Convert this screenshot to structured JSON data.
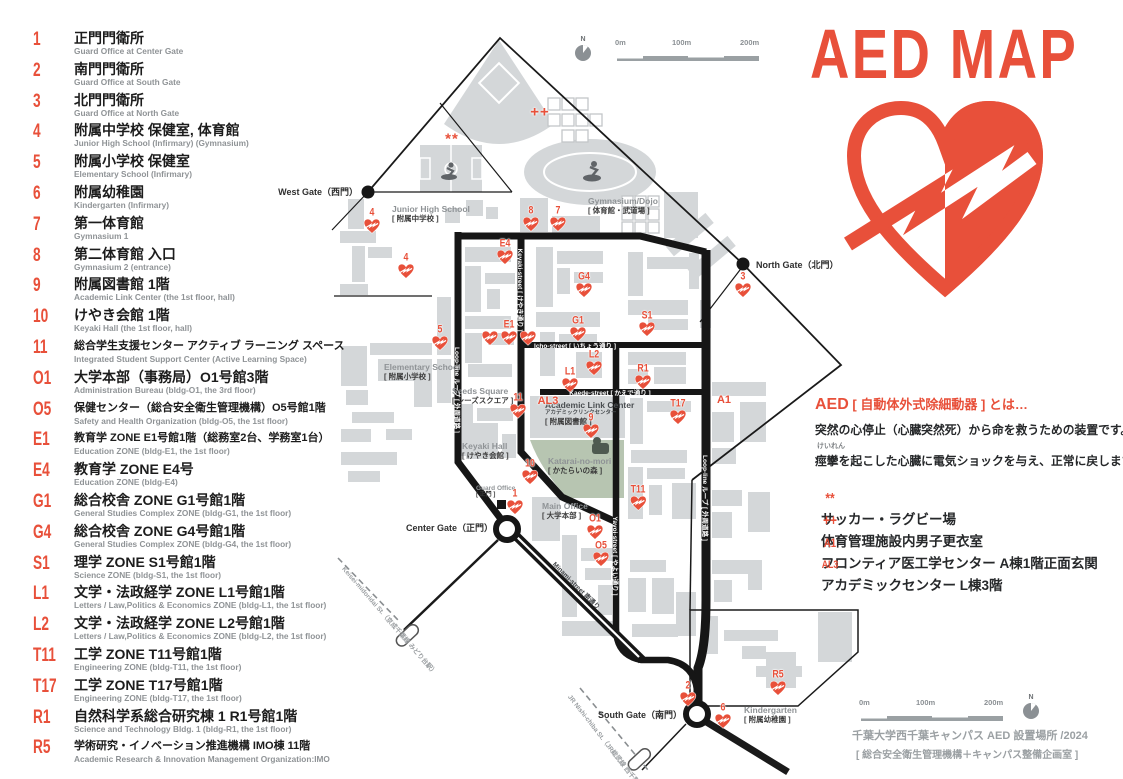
{
  "title": "AED MAP",
  "colors": {
    "red": "#e8503a",
    "building": "#d4d7d9",
    "road": "#161616",
    "green": "#b7c5b1"
  },
  "legend": {
    "items": [
      {
        "code": "1",
        "ja": "正門門衛所",
        "en": "Guard Office at Center Gate"
      },
      {
        "code": "2",
        "ja": "南門門衛所",
        "en": "Guard Office at South Gate"
      },
      {
        "code": "3",
        "ja": "北門門衛所",
        "en": "Guard Office at North Gate"
      },
      {
        "code": "4",
        "ja": "附属中学校 保健室, 体育館",
        "en": "Junior High School (Infirmary) (Gymnasium)"
      },
      {
        "code": "5",
        "ja": "附属小学校 保健室",
        "en": "Elementary School (Infirmary)"
      },
      {
        "code": "6",
        "ja": "附属幼稚園",
        "en": "Kindergarten (Infirmary)"
      },
      {
        "code": "7",
        "ja": "第一体育館",
        "en": "Gymnasium 1"
      },
      {
        "code": "8",
        "ja": "第二体育館 入口",
        "en": "Gymnasium 2 (entrance)"
      },
      {
        "code": "9",
        "ja": "附属図書館 1階",
        "en": "Academic Link Center (the 1st floor, hall)"
      },
      {
        "code": "10",
        "ja": "けやき会館 1階",
        "en": "Keyaki Hall (the 1st floor, hall)"
      },
      {
        "code": "11",
        "ja": "総合学生支援センター アクティブ ラーニング スペース",
        "en": "Integrated Student Support Center (Active Learning Space)"
      },
      {
        "code": "O1",
        "ja": "大学本部（事務局）O1号館3階",
        "en": "Administration Bureau (bldg-O1, the 3rd floor)"
      },
      {
        "code": "O5",
        "ja": "保健センター（総合安全衛生管理機構）O5号館1階",
        "en": "Safety and Health Organization (bldg-O5, the 1st floor)"
      },
      {
        "code": "E1",
        "ja": "教育学 ZONE E1号館1階（総務室2台、学務室1台）",
        "en": "Education ZONE (bldg-E1, the 1st floor)"
      },
      {
        "code": "E4",
        "ja": "教育学 ZONE E4号",
        "en": "Education ZONE (bldg-E4)"
      },
      {
        "code": "G1",
        "ja": "総合校舎 ZONE G1号館1階",
        "en": "General Studies Complex ZONE (bldg-G1, the 1st floor)"
      },
      {
        "code": "G4",
        "ja": "総合校舎 ZONE G4号館1階",
        "en": "General Studies Complex ZONE (bldg-G4, the 1st floor)"
      },
      {
        "code": "S1",
        "ja": "理学 ZONE S1号館1階",
        "en": "Science ZONE (bldg-S1, the 1st floor)"
      },
      {
        "code": "L1",
        "ja": "文学・法政経学 ZONE L1号館1階",
        "en": "Letters / Law,Politics & Economics ZONE (bldg-L1, the 1st floor)"
      },
      {
        "code": "L2",
        "ja": "文学・法政経学 ZONE L2号館1階",
        "en": "Letters / Law,Politics & Economics ZONE (bldg-L2, the 1st floor)"
      },
      {
        "code": "T11",
        "ja": "工学 ZONE T11号館1階",
        "en": "Engineering ZONE (bldg-T11, the 1st floor)"
      },
      {
        "code": "T17",
        "ja": "工学 ZONE T17号館1階",
        "en": "Engineering ZONE (bldg-T17, the 1st floor)"
      },
      {
        "code": "R1",
        "ja": "自然科学系総合研究棟 1  R1号館1階",
        "en": "Science and Technology Bldg. 1 (bldg-R1, the 1st floor)"
      },
      {
        "code": "R5",
        "ja": "学術研究・イノベーション推進機構 IMO棟 11階",
        "en": "Academic Research & Innovation Management Organization:IMO"
      }
    ]
  },
  "info": {
    "heading_code": "AED",
    "heading_rest": " [ 自動体外式除細動器 ] とは…",
    "body1": "突然の心停止（心臓突然死）から命を救うための装置です。",
    "furigana": "けいれん",
    "body2": "痙攣を起こした心臓に電気ショックを与え、正常に戻します。",
    "notes": [
      {
        "code": "**",
        "label": "サッカー・ラグビー場"
      },
      {
        "code": "++",
        "label": "体育管理施設内男子更衣室"
      },
      {
        "code": "A1",
        "label": "フロンティア医工学センター A棟1階正面玄関"
      },
      {
        "code": "AL3",
        "label": "アカデミックセンター L棟3階"
      }
    ]
  },
  "credit": {
    "line1": "千葉大学西千葉キャンパス AED 設置場所 /2024",
    "line2": "[ 総合安全衛生管理機構＋キャンパス整備企画室 ]"
  },
  "scalebar": {
    "labels": [
      "0m",
      "100m",
      "200m"
    ],
    "north": "N"
  },
  "map": {
    "gates": [
      {
        "name": "West Gate（西門）",
        "x": 358,
        "y": 185,
        "align": "right"
      },
      {
        "name": "North Gate（北門）",
        "x": 756,
        "y": 258,
        "align": "left"
      },
      {
        "name": "Center Gate（正門）",
        "x": 493,
        "y": 521,
        "align": "right"
      },
      {
        "name": "South Gate（南門）",
        "x": 682,
        "y": 708,
        "align": "right"
      }
    ],
    "places": [
      {
        "en": "Junior High School",
        "ja": "[ 附属中学校 ]",
        "x": 392,
        "y": 204
      },
      {
        "en": "Elementary School",
        "ja": "[ 附属小学校 ]",
        "x": 384,
        "y": 362
      },
      {
        "en": "Gymnasium/Dojo",
        "ja": "[ 体育館・武道場 ]",
        "x": 588,
        "y": 196
      },
      {
        "en": "Seeds Square",
        "ja": "[ シーズスクエア ]",
        "x": 452,
        "y": 386
      },
      {
        "en": "Academic Link Center",
        "sub": "アカデミックリンクセンター",
        "ja": "[ 附属図書館 ]",
        "x": 545,
        "y": 400,
        "dark": true
      },
      {
        "en": "Katarai-no-mori",
        "ja": "[ かたらいの森 ]",
        "x": 548,
        "y": 456
      },
      {
        "en": "Keyaki Hall",
        "ja": "[ けやき会館 ]",
        "x": 462,
        "y": 441
      },
      {
        "en": "Guard Office",
        "ja": "[ 正門 ]",
        "x": 476,
        "y": 485,
        "small": true
      },
      {
        "en": "Main Office",
        "ja": "[ 大学本部 ]",
        "x": 542,
        "y": 501
      },
      {
        "en": "Kindergarten",
        "ja": "[ 附属幼稚園 ]",
        "x": 744,
        "y": 705
      }
    ],
    "streets": [
      {
        "label": "Keyaki-street [ けやき通り ]",
        "x": 521,
        "y": 290,
        "rot": 90
      },
      {
        "label": "Icho-street [ いちょう通り ]",
        "x": 575,
        "y": 345,
        "rot": 0
      },
      {
        "label": "Kaede-street [ かえで通り ]",
        "x": 610,
        "y": 392,
        "rot": 0
      },
      {
        "label": "Yayoi-street [ やよい通り ]",
        "x": 616,
        "y": 556,
        "rot": 90
      },
      {
        "label": "Loop-line ループ [ 外周道路 ]",
        "x": 458,
        "y": 390,
        "rot": 90
      },
      {
        "label": "Loop-line ループ [ 外周道路 ]",
        "x": 706,
        "y": 498,
        "rot": 90
      },
      {
        "label": "Minami-street 南通り",
        "x": 577,
        "y": 585,
        "rot": 45,
        "dark": true
      }
    ],
    "rails": [
      {
        "label": "Keisei-midoridai St.（京成千葉線 みどり台駅）",
        "x": 344,
        "y": 562,
        "rot": 49
      },
      {
        "label": "JR Nishi-chiba St.（JR総武線 西千葉駅）",
        "x": 570,
        "y": 690,
        "rot": 52
      }
    ],
    "markers": [
      {
        "code": "4",
        "x": 372,
        "y": 226
      },
      {
        "code": "4",
        "x": 406,
        "y": 271
      },
      {
        "code": "5",
        "x": 440,
        "y": 343
      },
      {
        "code": "8",
        "x": 531,
        "y": 224
      },
      {
        "code": "7",
        "x": 558,
        "y": 224
      },
      {
        "code": "E4",
        "x": 505,
        "y": 257
      },
      {
        "code": "E1",
        "x": 509,
        "y": 338,
        "hearts": 3
      },
      {
        "code": "G4",
        "x": 584,
        "y": 290
      },
      {
        "code": "G1",
        "x": 578,
        "y": 334
      },
      {
        "code": "S1",
        "x": 647,
        "y": 329
      },
      {
        "code": "3",
        "x": 743,
        "y": 290
      },
      {
        "code": "L2",
        "x": 594,
        "y": 368
      },
      {
        "code": "L1",
        "x": 570,
        "y": 385
      },
      {
        "code": "R1",
        "x": 643,
        "y": 382
      },
      {
        "code": "11",
        "x": 518,
        "y": 411
      },
      {
        "code": "9",
        "x": 591,
        "y": 431
      },
      {
        "code": "T17",
        "x": 678,
        "y": 417
      },
      {
        "code": "10",
        "x": 530,
        "y": 477
      },
      {
        "code": "1",
        "x": 515,
        "y": 507
      },
      {
        "code": "T11",
        "x": 638,
        "y": 503
      },
      {
        "code": "O1",
        "x": 595,
        "y": 532
      },
      {
        "code": "O5",
        "x": 601,
        "y": 559
      },
      {
        "code": "2",
        "x": 688,
        "y": 699
      },
      {
        "code": "6",
        "x": 723,
        "y": 721
      },
      {
        "code": "R5",
        "x": 778,
        "y": 688
      },
      {
        "code": "**",
        "x": 452,
        "y": 139,
        "text_only": true,
        "big": true
      },
      {
        "code": "++",
        "x": 540,
        "y": 112,
        "text_only": true,
        "big": true
      },
      {
        "code": "AL3",
        "x": 548,
        "y": 401,
        "text_only": true
      },
      {
        "code": "A1",
        "x": 724,
        "y": 400,
        "text_only": true
      }
    ]
  }
}
